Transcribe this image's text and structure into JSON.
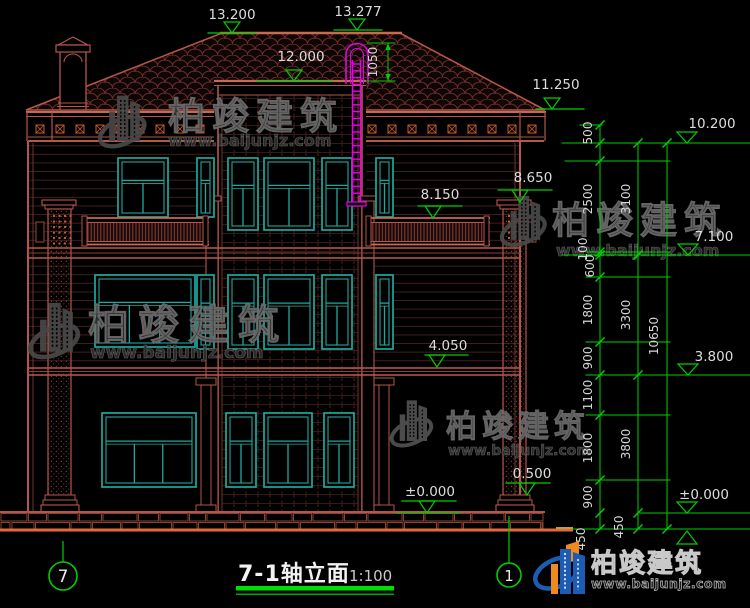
{
  "drawing": {
    "title": "7-1轴立面",
    "scale": "1:100",
    "axis_bubbles": {
      "left": "7",
      "right": "1"
    },
    "top_marks": {
      "ridge_left": "13.200",
      "ridge_peak": "13.277",
      "tower_roof": "12.000",
      "ladder_dim": "1050",
      "eave_right": "11.250"
    },
    "facade_marks": {
      "parapet_right": "8.650",
      "balcony": "8.150",
      "floor2": "4.050",
      "plinth": "0.500",
      "ground": "±0.000"
    },
    "right_column": {
      "inner_segments": [
        "500",
        "2500",
        "100",
        "600",
        "1800",
        "900",
        "1100",
        "1800",
        "900",
        "450"
      ],
      "mid_segments": [
        "3100",
        "3300",
        "3800",
        "450"
      ],
      "total": "10650",
      "levels": {
        "l10200": "10.200",
        "l7100": "7.100",
        "l3800": "3.800",
        "l0": "±0.000"
      }
    }
  },
  "watermark": {
    "brand": "柏竣建筑",
    "website": "www.baijunjz.com"
  },
  "logo": {
    "brand": "柏竣建筑",
    "website": "www.baijunjz.com"
  },
  "colors": {
    "background": "#000000",
    "line_red": "#b5564a",
    "window_teal": "#1fa89d",
    "dimension_green": "#00cf00",
    "ladder_magenta": "#e800e8",
    "ground_orange": "#e4683c",
    "logo_blue": "#1d5cb5",
    "logo_orange": "#f08a1c"
  }
}
